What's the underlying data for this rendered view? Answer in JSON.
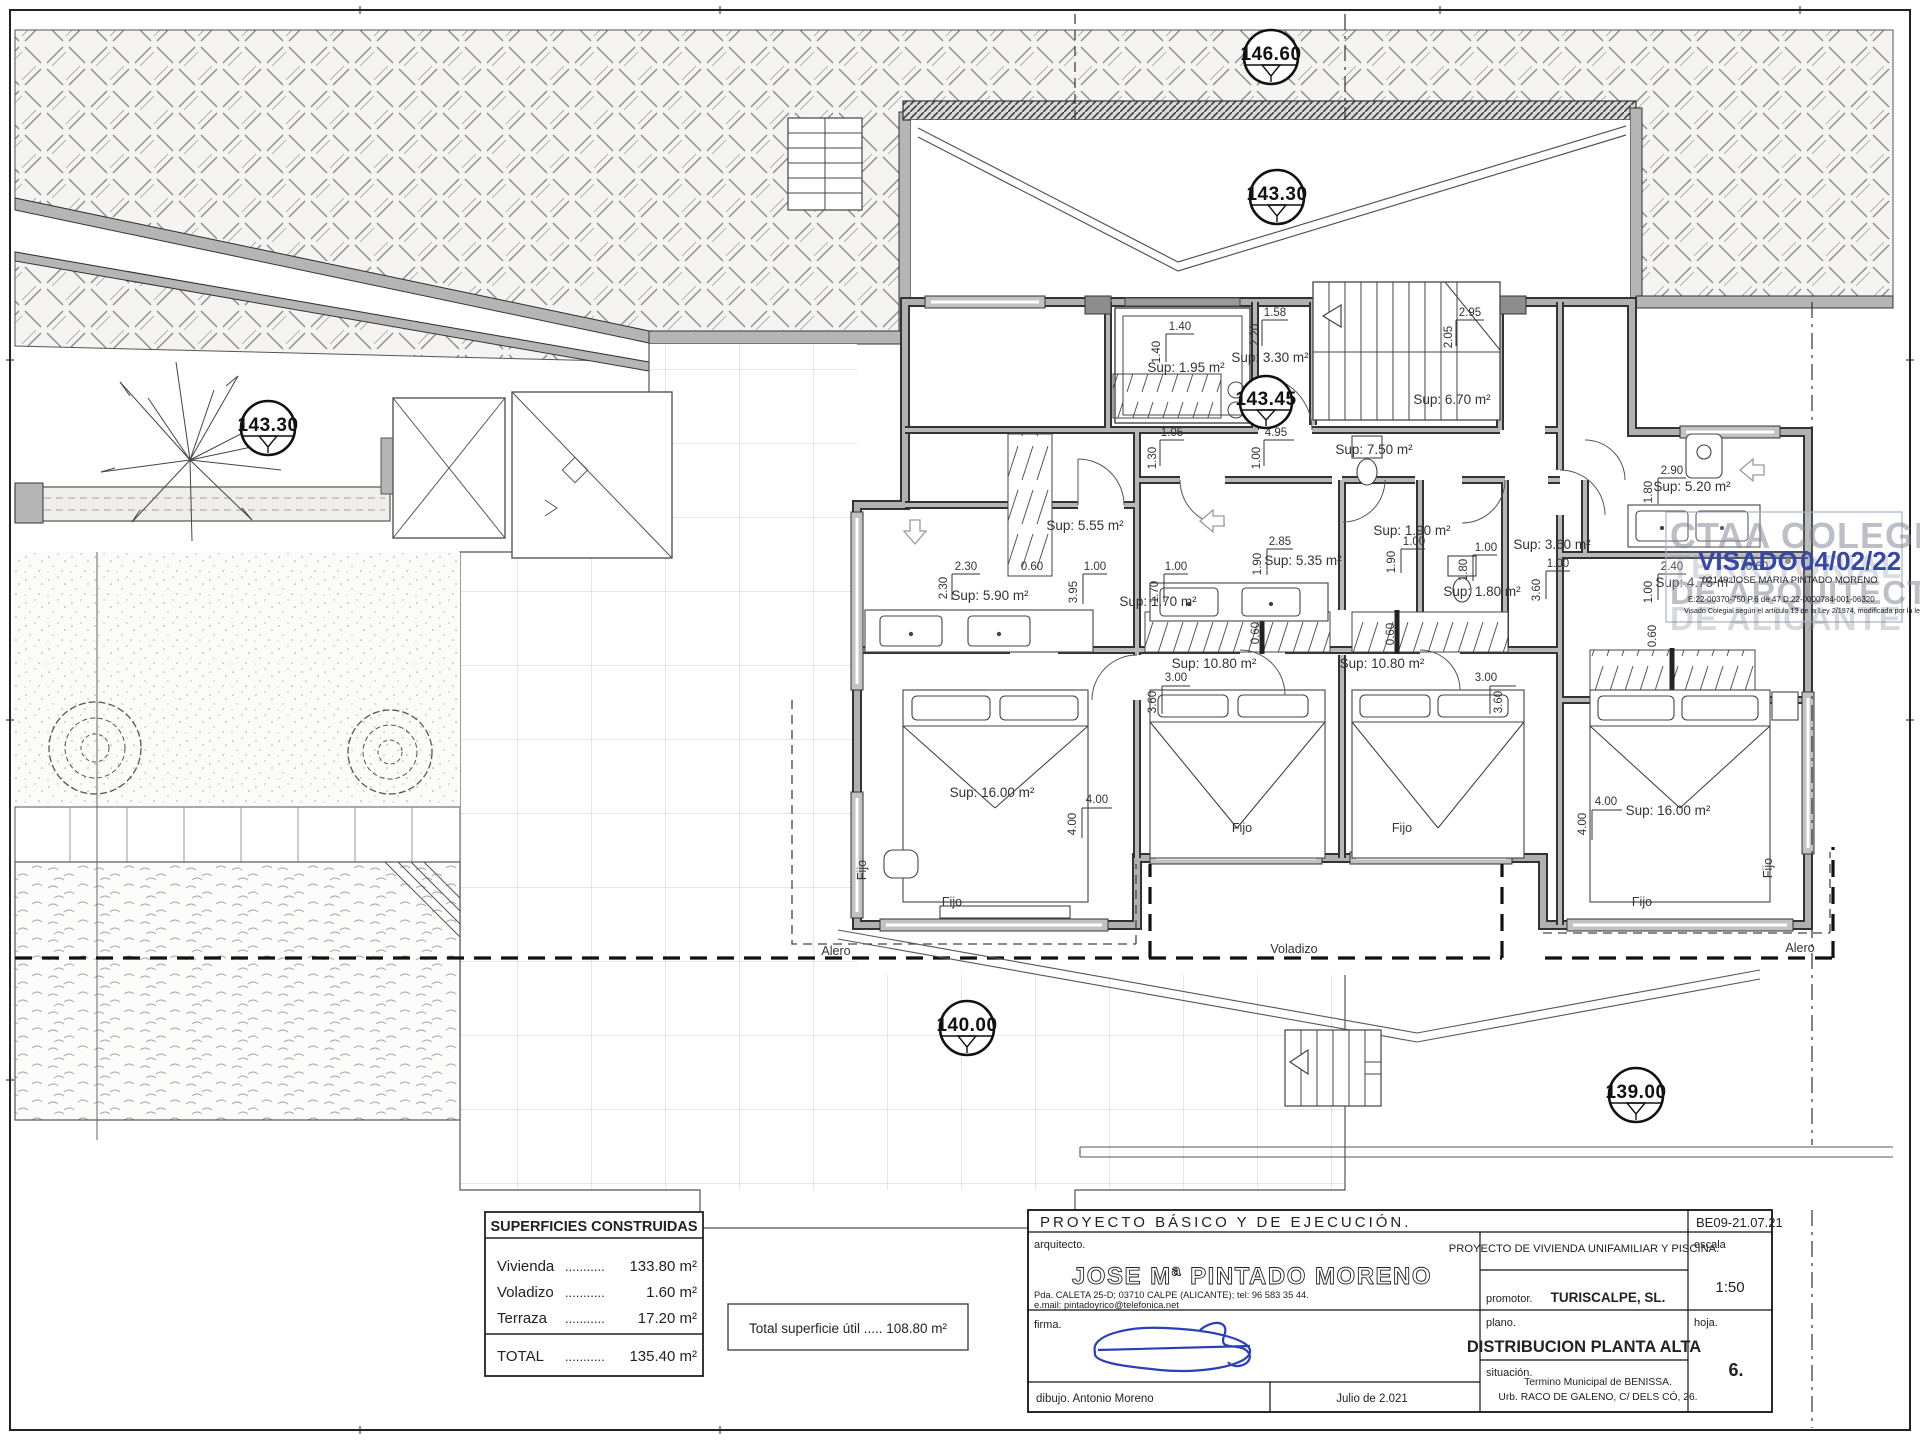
{
  "markers": {
    "e14660": "146.60",
    "e14330": "143.30",
    "e14345": "143.45",
    "e14000": "140.00",
    "e13900": "139.00"
  },
  "rooms": {
    "lift": "Sup: 1.95 m²",
    "hall_top": "Sup: 3.30 m²",
    "stairs": "Sup: 6.70 m²",
    "corridor": "Sup: 7.50 m²",
    "closet_left": "Sup: 5.55 m²",
    "dressing_left": "Sup: 5.90 m²",
    "wc_left": "Sup: 1.70 m²",
    "bath_mid": "Sup: 5.35 m²",
    "wc_mid": "Sup: 1.90 m²",
    "bath_mid2": "Sup: 1.80 m²",
    "hall_right": "Sup: 3.60 m²",
    "bath_right": "Sup: 5.20 m²",
    "dressing_right": "Sup: 4.75 m²",
    "bedroom_mid_left": "Sup: 10.80 m²",
    "bedroom_mid_right": "Sup: 10.80 m²",
    "bedroom_left": "Sup: 16.00 m²",
    "bedroom_right": "Sup: 16.00 m²"
  },
  "dims": {
    "v060": "0.60",
    "v100": "1.00",
    "v105": "1.05",
    "v130": "1.30",
    "v140": "1.40",
    "v158": "1.58",
    "v170": "1.70",
    "v180": "1.80",
    "v190": "1.90",
    "v205": "2.05",
    "v220": "2.20",
    "v230": "2.30",
    "v240": "2.40",
    "v285": "2.85",
    "v290": "2.90",
    "v295": "2.95",
    "v300": "3.00",
    "v360": "3.60",
    "v395": "3.95",
    "v400": "4.00",
    "v495": "4.95"
  },
  "notes": {
    "fijo": "Fijo",
    "alero": "Alero",
    "voladizo": "Voladizo"
  },
  "surfaces": {
    "title": "SUPERFICIES CONSTRUIDAS",
    "rows": [
      {
        "label": "Vivienda",
        "dots": "...........",
        "value": "133.80 m²"
      },
      {
        "label": "Voladizo",
        "dots": "...........",
        "value": "1.60 m²"
      },
      {
        "label": "Terraza",
        "dots": "...........",
        "value": "17.20 m²"
      }
    ],
    "total_label": "TOTAL",
    "total_dots": "...........",
    "total_value": "135.40 m²"
  },
  "total_util": "Total superficie útil ..... 108.80 m²",
  "title_block": {
    "project": "PROYECTO  BÁSICO  Y  DE  EJECUCIÓN.",
    "code": "BE09-21.07.21",
    "architect_label": "arquitecto.",
    "architect_name": "JOSE Mª PINTADO MORENO",
    "architect_addr": "Pda. CALETA 25-D; 03710 CALPE (ALICANTE); tel: 96 583 35 44.",
    "architect_email": "e.mail: pintadoyrico@telefonica.net",
    "project_desc": "PROYECTO  DE  VIVIENDA  UNIFAMILIAR  Y  PISCINA.",
    "promoter_label": "promotor.",
    "promoter": "TURISCALPE, SL.",
    "scale_label": "escala",
    "scale": "1:50",
    "firma_label": "firma.",
    "plano_label": "plano.",
    "plano": "DISTRIBUCION  PLANTA  ALTA",
    "situacion_label": "situación.",
    "situacion1": "Termino Municipal de BENISSA.",
    "situacion2": "Urb. RACO DE GALENO, C/ DELS CÓ, 26.",
    "hoja_label": "hoja.",
    "hoja": "6.",
    "dibujo": "dibujo.  Antonio Moreno",
    "fecha": "Julio de 2.021"
  },
  "stamp": {
    "wm1": "CTAA COLEGIO",
    "wm2": "TERRITORIAL",
    "wm3": "DE ARQUITECTOS",
    "wm4": "DE ALICANTE",
    "visado": "VISADO .",
    "date": "04/02/22",
    "colegiado": "02149 JOSE MARIA PINTADO MORENO",
    "codes": "E:22-00370-750      P.6 de 47      D:22-0000784-001-06320",
    "legal": "Visado Colegial según el artículo 13 de la Ley 2/1974, modificada por la ley 25/2009"
  }
}
